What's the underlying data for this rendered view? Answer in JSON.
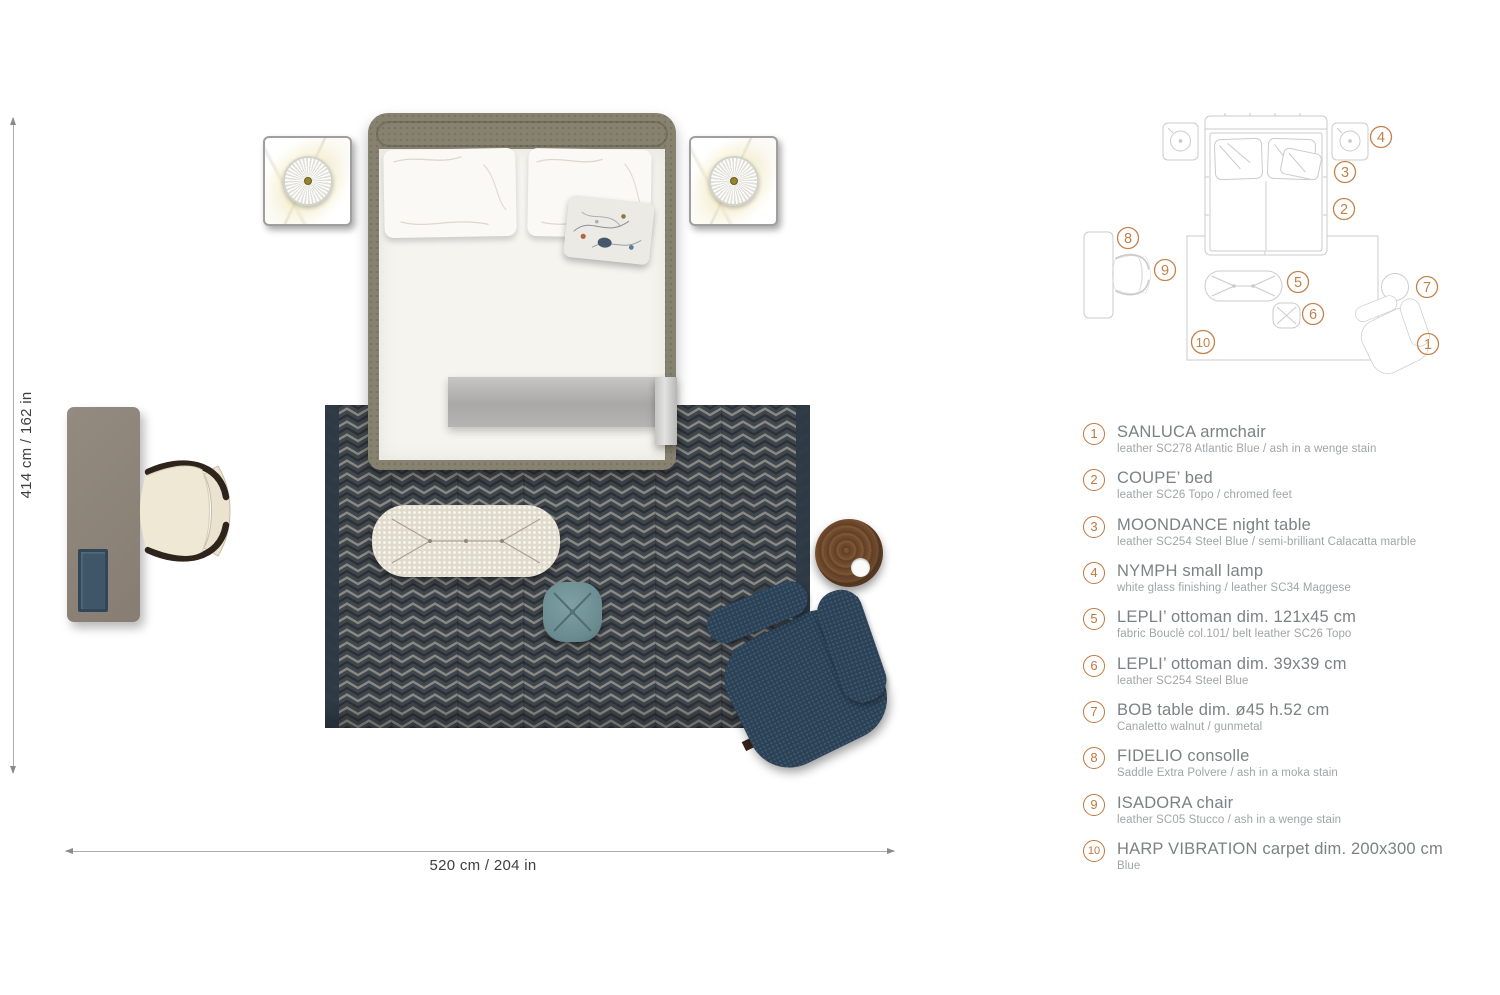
{
  "accent_color": "#c0763c",
  "plan": {
    "dim_vertical": "414 cm / 162 in",
    "dim_horizontal": "520 cm / 204 in",
    "colors": {
      "carpet": "#44484e",
      "carpet_border": "#2e3945",
      "bed_frame": "#87816f",
      "mattress": "#f6f4ef",
      "armchair": "#2b4156",
      "console": "#8d8378",
      "console_tray": "#3f5669",
      "ottoman_large": "#e0dacc",
      "ottoman_small": "#6a8c90",
      "chair_seat": "#efe8d5",
      "chair_frame": "#2e241c",
      "table_wood": "#6d4a2b",
      "lamp_center": "#97842f"
    }
  },
  "legend": {
    "items": [
      {
        "num": "1",
        "title": "SANLUCA armchair",
        "subtitle": "leather SC278 Atlantic Blue / ash in a wenge stain"
      },
      {
        "num": "2",
        "title": "COUPE’ bed",
        "subtitle": "leather SC26 Topo / chromed feet"
      },
      {
        "num": "3",
        "title": "MOONDANCE night table",
        "subtitle": "leather SC254 Steel Blue / semi-brilliant Calacatta marble"
      },
      {
        "num": "4",
        "title": "NYMPH small lamp",
        "subtitle": "white glass finishing / leather SC34 Maggese"
      },
      {
        "num": "5",
        "title": "LEPLI’ ottoman dim. 121x45 cm",
        "subtitle": "fabric Bouclè col.101/ belt leather SC26 Topo"
      },
      {
        "num": "6",
        "title": "LEPLI’ ottoman dim. 39x39 cm",
        "subtitle": "leather SC254 Steel Blue"
      },
      {
        "num": "7",
        "title": "BOB table dim. ø45 h.52 cm",
        "subtitle": "Canaletto walnut / gunmetal"
      },
      {
        "num": "8",
        "title": "FIDELIO consolle",
        "subtitle": "Saddle Extra Polvere / ash in a moka stain"
      },
      {
        "num": "9",
        "title": "ISADORA chair",
        "subtitle": "leather SC05 Stucco / ash in a wenge stain"
      },
      {
        "num": "10",
        "title": "HARP VIBRATION carpet dim. 200x300 cm",
        "subtitle": "Blue"
      }
    ]
  }
}
